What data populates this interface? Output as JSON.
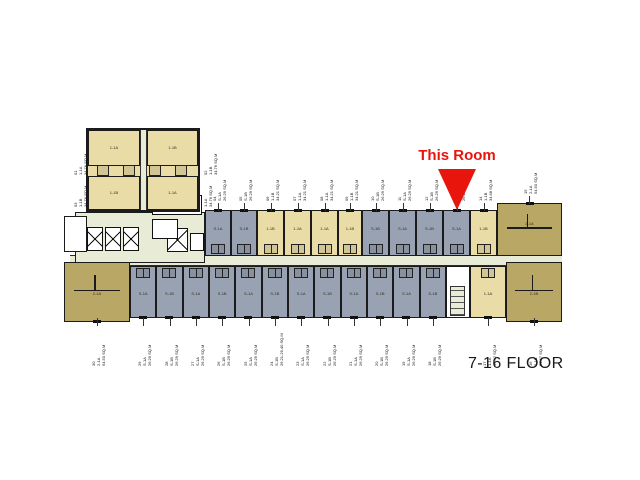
{
  "title": {
    "text": "7-16 FLOOR"
  },
  "callout": {
    "text": "This Room",
    "arrow_icon": "triangle-down-icon",
    "color": "#e8150d"
  },
  "colors": {
    "beige": "#e9dca6",
    "dark_tan": "#b9a765",
    "gray": "#99a2b2",
    "corridor": "#e8ecd6",
    "wall": "#1b1b1b",
    "background": "#ffffff",
    "callout_red": "#e8150d"
  },
  "tower_units": [
    {
      "no": "01",
      "type": "1-1A",
      "area": "34.76 SQ.M"
    },
    {
      "no": "02",
      "type": "1-1B",
      "area": "34.76 SQ.M"
    },
    {
      "no": "03",
      "type": "1-1B",
      "area": "34.76 SQ.M"
    },
    {
      "no": "",
      "type": "1-1A",
      "area": "34.76 SQ.M"
    }
  ],
  "top_row": [
    {
      "no": "04",
      "type": "S-1A",
      "area": "26.29 SQ.M",
      "color": "gray"
    },
    {
      "no": "05",
      "type": "S-1B",
      "area": "26.29 SQ.M",
      "color": "gray"
    },
    {
      "no": "06",
      "type": "1-1B",
      "area": "34.21 SQ.M",
      "color": "beige"
    },
    {
      "no": "07",
      "type": "1-1A",
      "area": "34.21 SQ.M",
      "color": "beige"
    },
    {
      "no": "08",
      "type": "1-1A",
      "area": "34.21 SQ.M",
      "color": "beige"
    },
    {
      "no": "09",
      "type": "1-1B",
      "area": "34.21 SQ.M",
      "color": "beige"
    },
    {
      "no": "10",
      "type": "S-1B",
      "area": "26.29 SQ.M",
      "color": "gray"
    },
    {
      "no": "11",
      "type": "S-1A",
      "area": "26.29 SQ.M",
      "color": "gray"
    },
    {
      "no": "12",
      "type": "S-1B",
      "area": "26.29 SQ.M",
      "color": "gray"
    },
    {
      "no": "13",
      "type": "S-1A",
      "area": "26.29 SQ.M",
      "color": "gray",
      "this_room": true
    },
    {
      "no": "14",
      "type": "1-1B",
      "area": "34.68 SQ.M",
      "color": "beige"
    }
  ],
  "right_top_corner": {
    "no": "15",
    "type": "2-1A",
    "area": "54.50 SQ.M",
    "color": "dark"
  },
  "bottom_row": [
    {
      "no": "30",
      "type": "2-1A",
      "area": "54.50 SQ.M",
      "color": "dark"
    },
    {
      "no": "29",
      "type": "S-1A",
      "area": "26.29 SQ.M",
      "color": "gray"
    },
    {
      "no": "28",
      "type": "S-1B",
      "area": "26.29 SQ.M",
      "color": "gray"
    },
    {
      "no": "27",
      "type": "S-1A",
      "area": "26.29 SQ.M",
      "color": "gray"
    },
    {
      "no": "26",
      "type": "S-1B",
      "area": "26.29 SQ.M",
      "color": "gray"
    },
    {
      "no": "25",
      "type": "S-1A",
      "area": "26.29 SQ.M",
      "color": "gray"
    },
    {
      "no": "24",
      "type": "S-1B",
      "area": "26.21-26.40 SQ.M",
      "color": "gray"
    },
    {
      "no": "23",
      "type": "S-1A",
      "area": "26.29 SQ.M",
      "color": "gray"
    },
    {
      "no": "22",
      "type": "S-1B",
      "area": "26.29 SQ.M",
      "color": "gray"
    },
    {
      "no": "21",
      "type": "S-1A",
      "area": "26.29 SQ.M",
      "color": "gray"
    },
    {
      "no": "20",
      "type": "S-1B",
      "area": "26.29 SQ.M",
      "color": "gray"
    },
    {
      "no": "19",
      "type": "S-1A",
      "area": "26.29 SQ.M",
      "color": "gray"
    },
    {
      "no": "18",
      "type": "S-1B",
      "area": "26.29 SQ.M",
      "color": "gray"
    },
    {
      "no": "17",
      "type": "1-1A",
      "area": "34.42 SQ.M",
      "color": "beige"
    },
    {
      "no": "16",
      "type": "2-1B",
      "area": "54.67 SQ.M",
      "color": "dark"
    }
  ],
  "core": {
    "elevator_count": 3,
    "icons": [
      "elevator-icon",
      "stair-icon",
      "mailboxes-icon"
    ]
  }
}
